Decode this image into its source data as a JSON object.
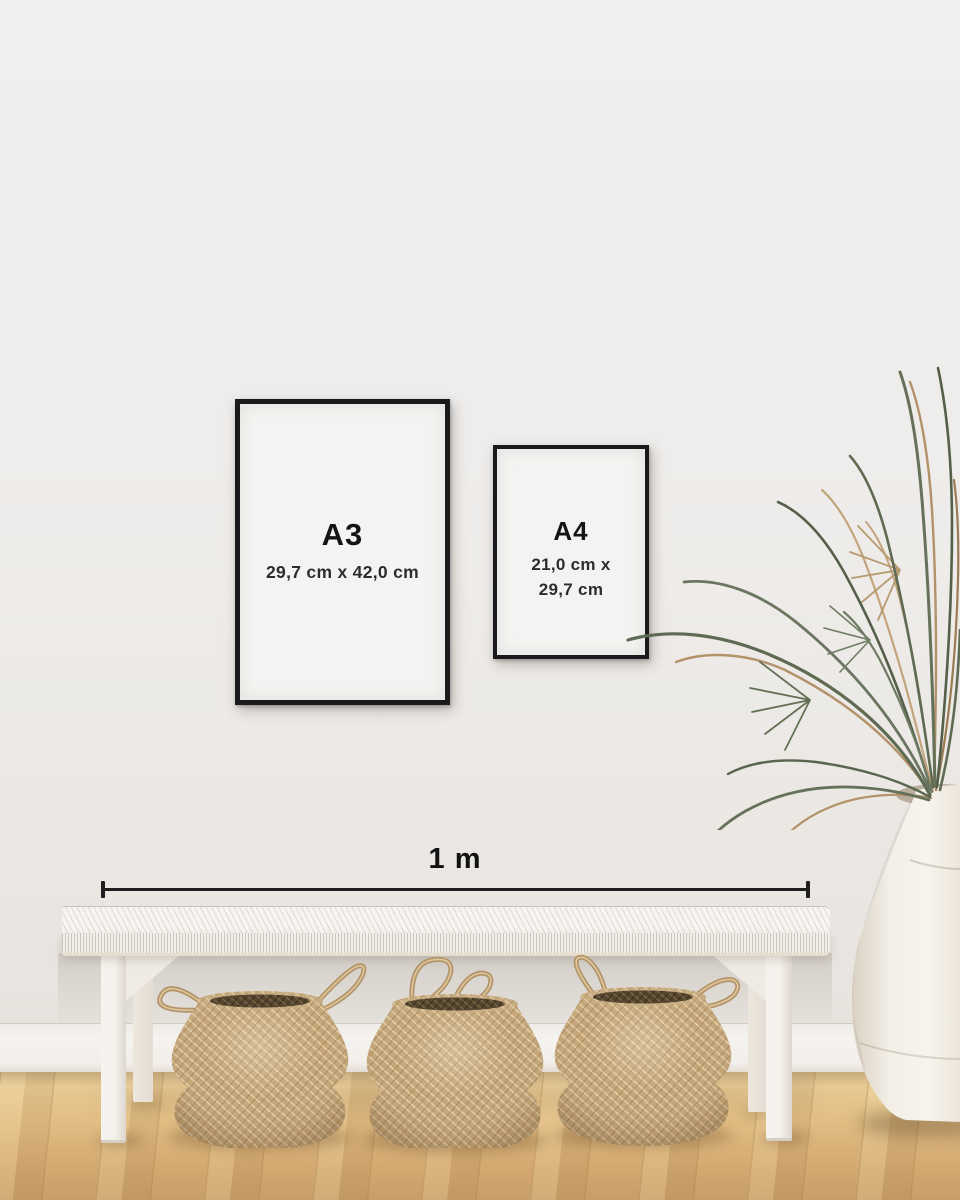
{
  "frames": {
    "a3": {
      "label": "A3",
      "dimensions": "29,7 cm x 42,0 cm"
    },
    "a4": {
      "label": "A4",
      "dimensions_line1": "21,0 cm x",
      "dimensions_line2": "29,7 cm"
    }
  },
  "measurement": {
    "label": "1 m"
  },
  "scene_objects": {
    "plant": "dried palm fronds",
    "vase": "white ceramic floor urn",
    "bench": "white woven bench",
    "baskets": [
      "seagrass belly basket",
      "seagrass belly basket",
      "seagrass belly basket"
    ]
  },
  "colors": {
    "wall": "#efedeb",
    "frame_border": "#1a1a1d",
    "poster_paper": "#f4f3f1",
    "text": "#141414",
    "measure_line": "#1f1f1f",
    "floor_light": "#e9cf9b",
    "floor_dark": "#c89e68",
    "baseboard": "#f3f1ed",
    "bench": "#f5f2ee",
    "basket": "#c4a679",
    "leaf_green": "#5f6a52",
    "leaf_tan": "#b3926a",
    "vase": "#f2eee6"
  }
}
